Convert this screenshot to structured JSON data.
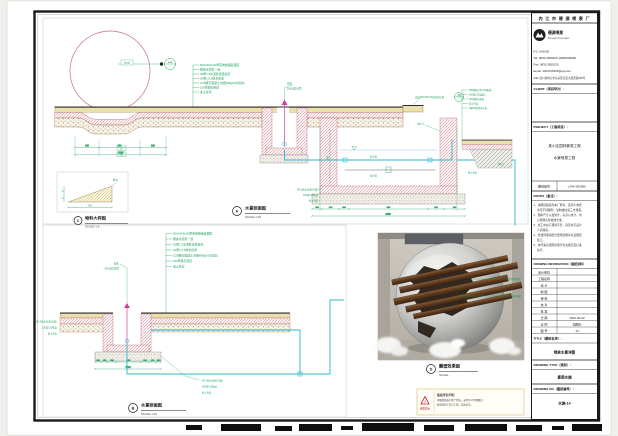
{
  "layers": [
    "600×600×20厚花岗岩铺装面层",
    "刷素水泥浆一道",
    "30厚1:3水泥砂浆结合层",
    "20厚1:2.5防水砂浆",
    "C25细石混凝土(内配Φ8@200双向)",
    "150厚碎石垫层",
    "素土夯实"
  ],
  "right_layers": [
    "50厚卵石(40~65)散铺",
    "100厚C15混凝土",
    "150厚碎石垫层",
    "素土夯实",
    "2厚DS砂浆防水层"
  ],
  "sections": {
    "a": {
      "letter": "A",
      "title": "水景剖面图",
      "scale": "SCALE  1:15"
    },
    "b": {
      "letter": "B",
      "title": "水景剖面图",
      "scale": "SCALE  1:15"
    },
    "c": {
      "letter": "C",
      "title": "物料大样图",
      "scale": "SCALE  1:5"
    },
    "d": {
      "letter": "D",
      "title": "雕塑效果图",
      "scale": "SCALE"
    }
  },
  "annotations": {
    "r700": "R700",
    "elev": "0.08",
    "coping": "成品600×300×25花岗岩压顶",
    "detail_bubble": "详图",
    "nozzle": "喷头",
    "supply_pipe": "DN25给水管",
    "drain_pipe": "泄水管",
    "supply2": "给水管",
    "overflow": "溢水口",
    "waterproof": "W1.5防水砂浆(20厚)",
    "c15": "100厚C15垫层",
    "c15b": "120厚C15垫层",
    "rammed": "素土夯实",
    "native_soil": "原状土",
    "edge_grind": "磨边"
  },
  "dims": {
    "a_left": [
      "200",
      "620",
      "200"
    ],
    "a_left_total": "1020",
    "a_pit": [
      "100",
      "170",
      "150",
      "580",
      "150",
      "100"
    ],
    "a_pit_total": "1350",
    "pit_depth": "550",
    "b_bottom": [
      "100",
      "120",
      "150",
      "480",
      "150",
      "120",
      "100"
    ],
    "b_total": "1220",
    "c_w": "200",
    "c_h1": "50",
    "c_h2": "30",
    "dip1": "50",
    "dip2": "100"
  },
  "photo": {
    "ann1": "304不锈钢锻打",
    "ann2": "耐候钢板"
  },
  "warning": {
    "badge": "重要提示",
    "heading": "版权所有声明：",
    "line1": "本图纸版权归本厂所有，未经许可不得翻印、",
    "line2": "复制或用于其它工程，违者必究。"
  },
  "title_block": {
    "company_header": "内 江 市 德 源 喷 泉 厂",
    "logo_name": "德源喷泉",
    "logo_name_en": "Deyuan Fountain",
    "contact": {
      "pc": "P.C: 641000",
      "tel": "Tel: 0832-2659225  13680339690",
      "fax": "Fax: 0832-2659225",
      "email": "Email: 1023706325@qq.com",
      "addr": "Add: 四川省内江市东兴区汉安大道西段260号"
    },
    "client_label": "CLIENT（项目甲方）:",
    "project_label": "PROJECT（工程项目）:",
    "project_line1": "某小区园林景观工程",
    "project_line2": "水景喷泉工程",
    "code_label": "图纸编号",
    "code_value": "LPW-093990",
    "notes_label": "NOTES（备注）:",
    "notes": [
      "1、本图纸版权为本厂所有，任何人未经",
      "　 许可不得翻印、复制或向第三方泄露。",
      "2、图中尺寸以毫米计，标高以米计，均",
      "　 以现场实际放线为准。",
      "3、施工中如与现场不符，请及时与设计",
      "　 人员联系。",
      "4、管线预埋请结合现场及相关专业图纸",
      "　 施工。",
      "5、未尽事宜按国家现行有关规范及标准",
      "　 执行。"
    ],
    "info_label": "DRAWING INFORMATION（图纸资料）:",
    "info_rows": [
      {
        "label": "设计单位",
        "value": ""
      },
      {
        "label": "工程名称",
        "value": ""
      },
      {
        "label": "设  计",
        "value": ""
      },
      {
        "label": "制  图",
        "value": ""
      },
      {
        "label": "审  核",
        "value": ""
      },
      {
        "label": "校  对",
        "value": ""
      },
      {
        "label": "批  准",
        "value": ""
      },
      {
        "label": "日  期",
        "value": "2022-09-02"
      },
      {
        "label": "比  例",
        "value": "如图示"
      },
      {
        "label": "图  号",
        "value": "14"
      }
    ],
    "title_label": "TITLE（图纸名称）:",
    "title_value": "喷泉水景详图",
    "type_label": "DRAWING TYPE（类别）:",
    "type_value": "景观水施",
    "no_label": "DRAWING NO（图纸编号）:",
    "no_value": "水施-14"
  }
}
